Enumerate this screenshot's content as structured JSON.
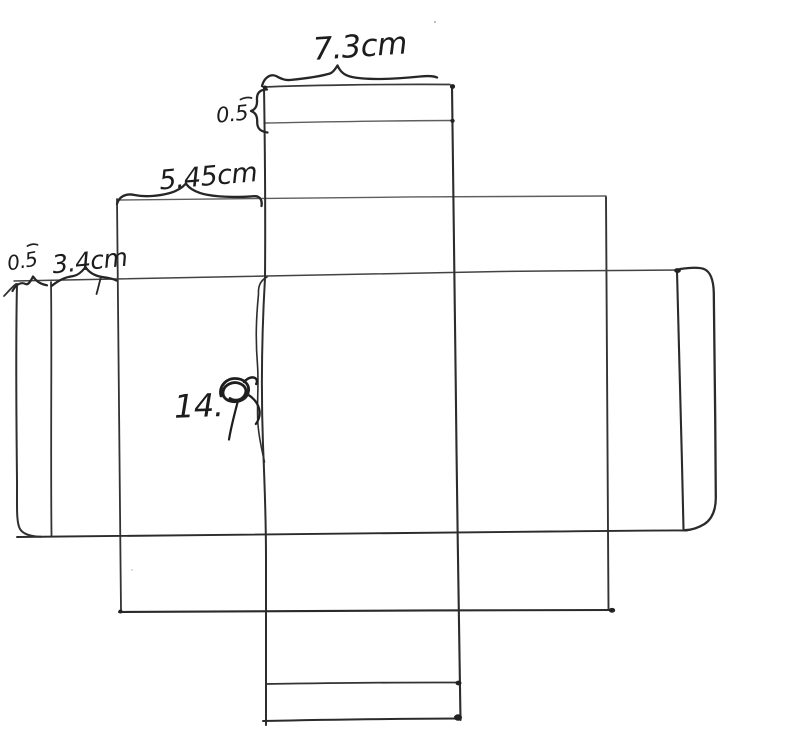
{
  "figure": {
    "kind": "hand-drawn box net (unfolded packaging) sketch",
    "ink_color": "#2b2b2b",
    "paper_color": "#ffffff"
  },
  "labels": {
    "top_width": "7.3cm",
    "top_flap_depth": "0.5",
    "upper_left_width": "5.45cm",
    "left_flap_width": "0.5",
    "left_panel_width": "3.4cm",
    "middle_height": "14.",
    "middle_height_scribbled": true
  }
}
